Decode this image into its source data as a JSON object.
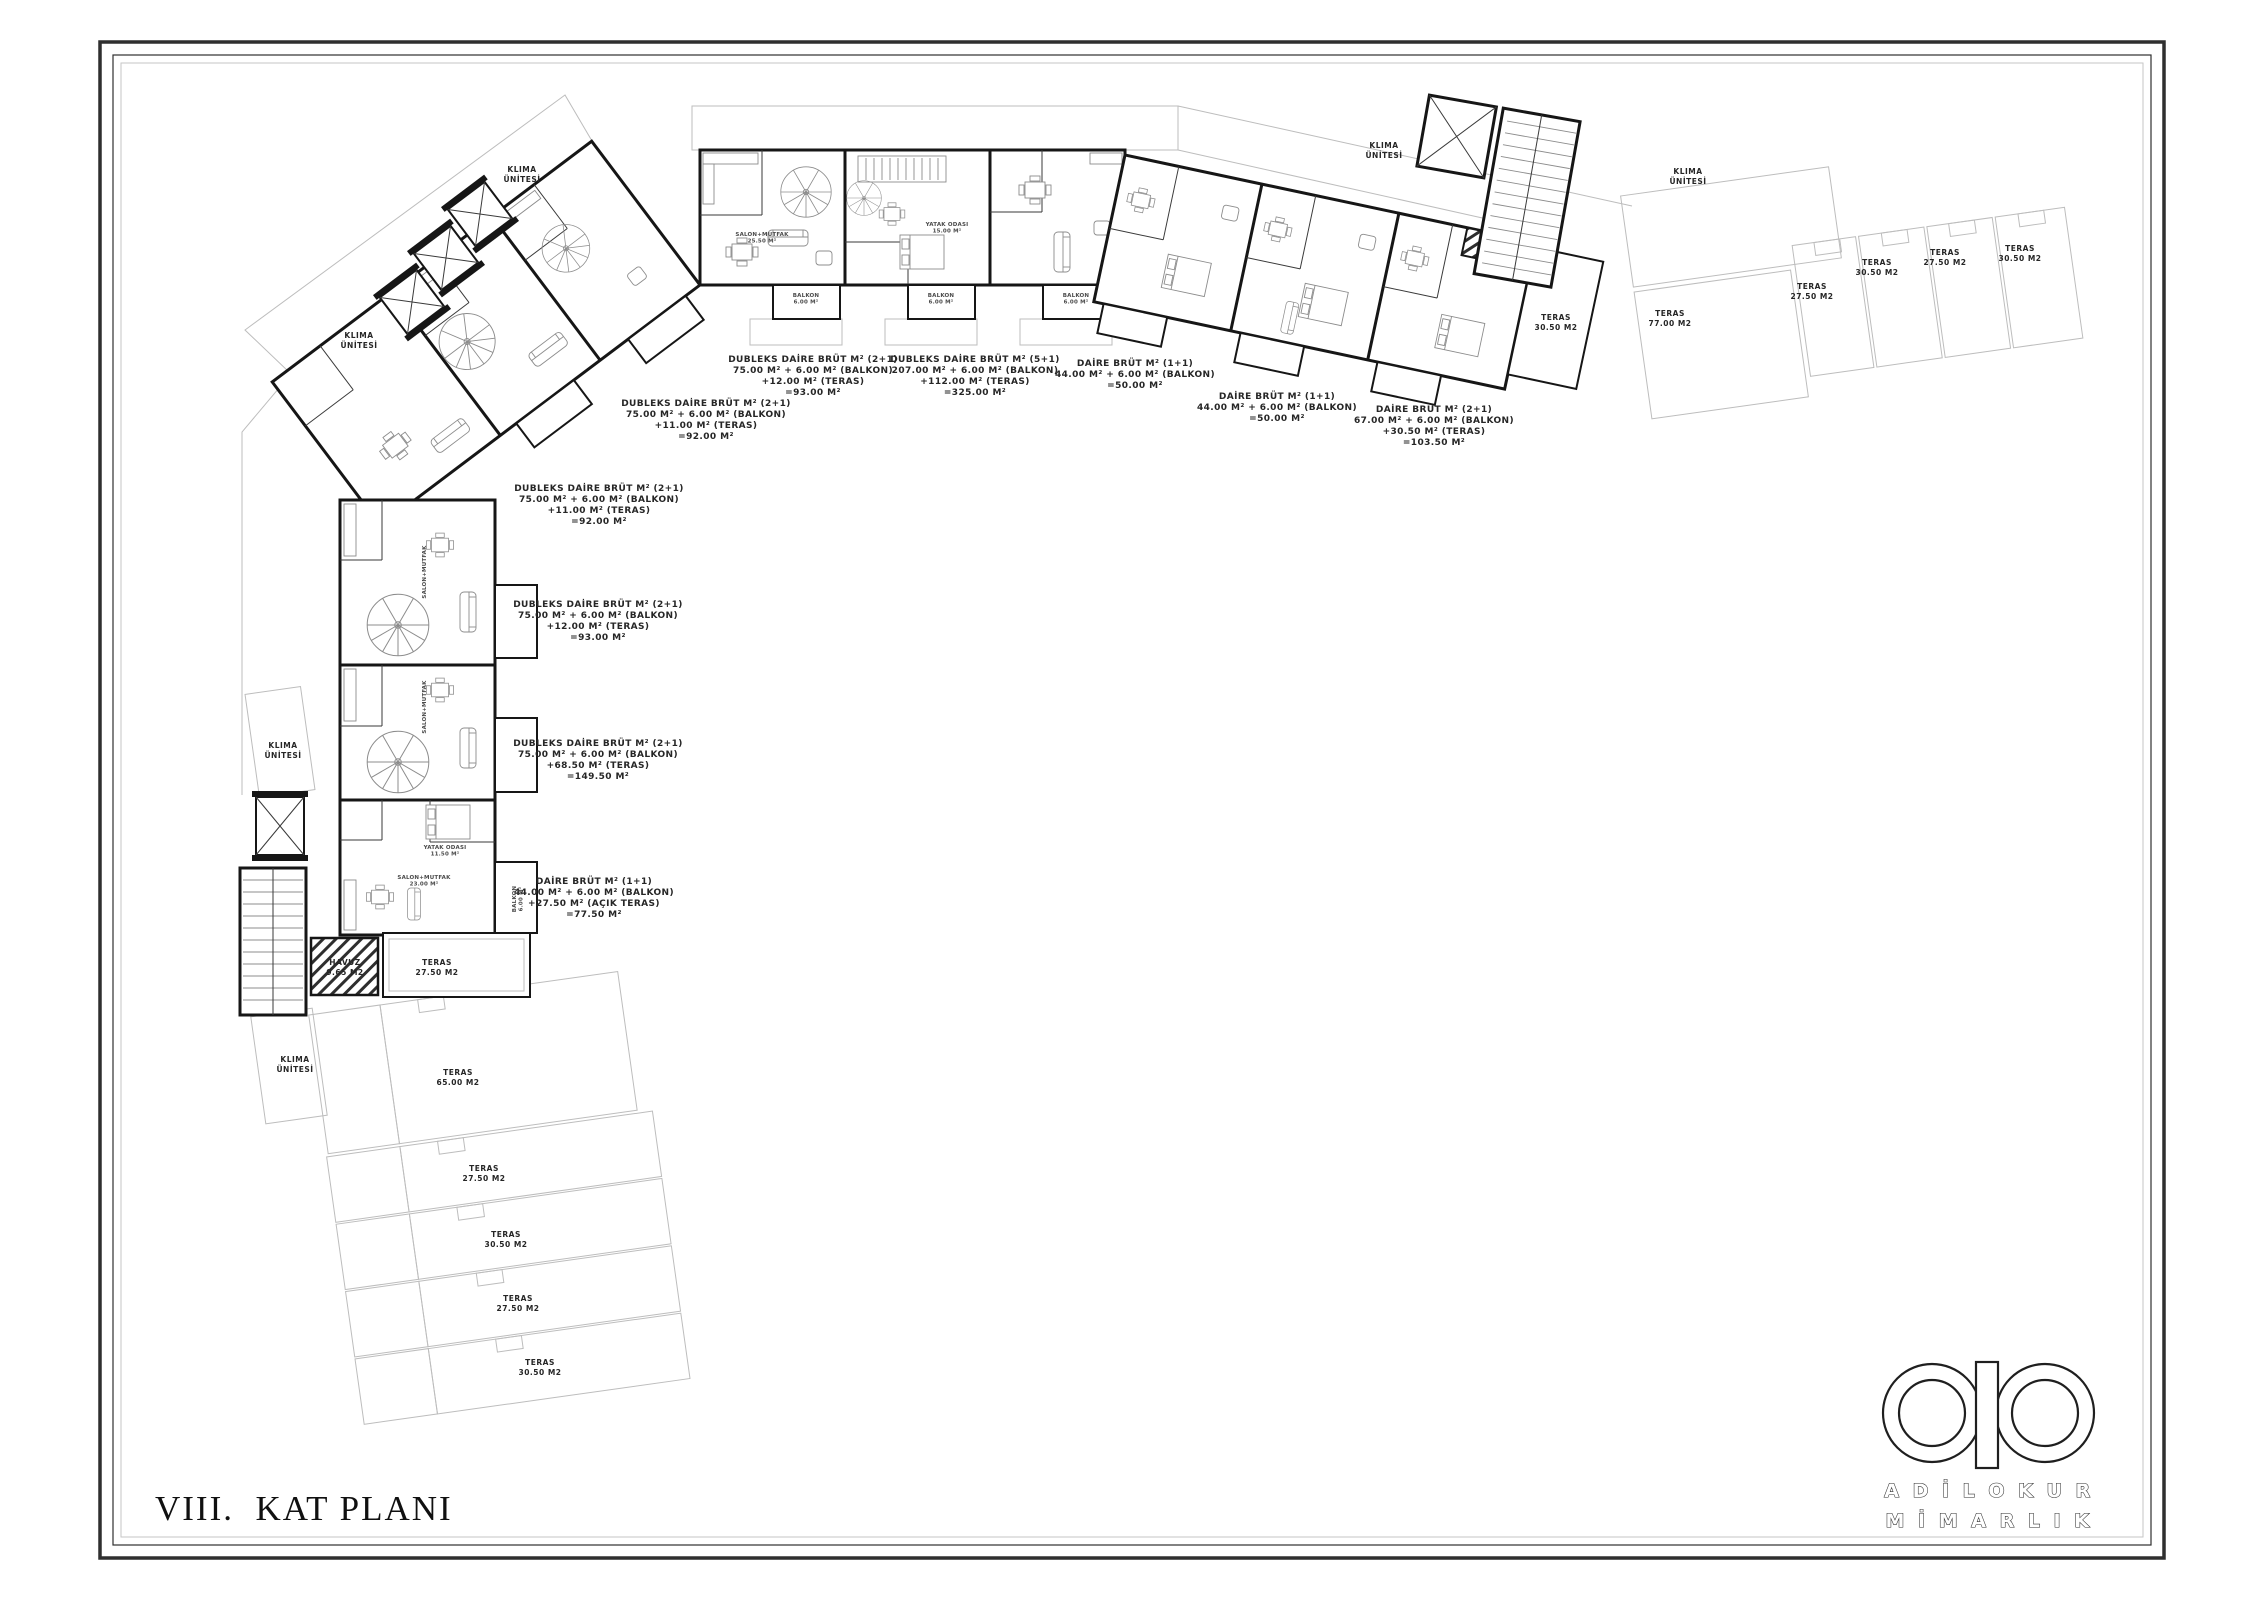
{
  "sheet": {
    "title": "VIII.  KAT PLANI"
  },
  "logo": {
    "line1": "A D İ L O K U R",
    "line2": "M İ M A R L I K"
  },
  "colors": {
    "wall": "#161616",
    "faint": "#bdbdbd",
    "furniture": "#8c8c8c",
    "text": "#262626"
  },
  "area_labels": [
    {
      "x": 813,
      "y": 362,
      "lines": [
        "DUBLEKS DAİRE BRÜT M² (2+1)",
        "75.00 M² + 6.00 M² (BALKON)",
        "+12.00 M² (TERAS)",
        "=93.00 M²"
      ]
    },
    {
      "x": 975,
      "y": 362,
      "lines": [
        "DUBLEKS DAİRE BRÜT M² (5+1)",
        "207.00 M² + 6.00 M² (BALKON)",
        "+112.00 M² (TERAS)",
        "=325.00 M²"
      ]
    },
    {
      "x": 1135,
      "y": 366,
      "lines": [
        "DAİRE BRÜT M² (1+1)",
        "44.00 M² + 6.00 M² (BALKON)",
        "=50.00 M²"
      ]
    },
    {
      "x": 706,
      "y": 406,
      "lines": [
        "DUBLEKS DAİRE BRÜT M² (2+1)",
        "75.00 M² + 6.00 M² (BALKON)",
        "+11.00 M² (TERAS)",
        "=92.00 M²"
      ]
    },
    {
      "x": 1277,
      "y": 399,
      "lines": [
        "DAİRE BRÜT M² (1+1)",
        "44.00 M² + 6.00 M² (BALKON)",
        "=50.00 M²"
      ]
    },
    {
      "x": 1434,
      "y": 412,
      "lines": [
        "DAİRE BRÜT M² (2+1)",
        "67.00 M² + 6.00 M² (BALKON)",
        "+30.50 M² (TERAS)",
        "=103.50 M²"
      ]
    },
    {
      "x": 599,
      "y": 491,
      "lines": [
        "DUBLEKS DAİRE BRÜT M² (2+1)",
        "75.00 M² + 6.00 M² (BALKON)",
        "+11.00 M² (TERAS)",
        "=92.00 M²"
      ]
    },
    {
      "x": 598,
      "y": 607,
      "lines": [
        "DUBLEKS DAİRE BRÜT M² (2+1)",
        "75.00 M² + 6.00 M² (BALKON)",
        "+12.00 M² (TERAS)",
        "=93.00 M²"
      ]
    },
    {
      "x": 598,
      "y": 746,
      "lines": [
        "DUBLEKS DAİRE BRÜT M² (2+1)",
        "75.00 M² + 6.00 M² (BALKON)",
        "+68.50 M² (TERAS)",
        "=149.50 M²"
      ]
    },
    {
      "x": 594,
      "y": 884,
      "lines": [
        "DAİRE BRÜT M² (1+1)",
        "44.00 M² + 6.00 M² (BALKON)",
        "+27.50 M² (AÇIK TERAS)",
        "=77.50 M²"
      ]
    }
  ],
  "klima_labels": [
    {
      "x": 522,
      "y": 172,
      "lines": [
        "KLIMA",
        "ÜNİTESİ"
      ]
    },
    {
      "x": 359,
      "y": 338,
      "lines": [
        "KLIMA",
        "ÜNİTESİ"
      ]
    },
    {
      "x": 283,
      "y": 748,
      "lines": [
        "KLIMA",
        "ÜNİTESİ"
      ]
    },
    {
      "x": 295,
      "y": 1062,
      "lines": [
        "KLIMA",
        "ÜNİTESİ"
      ]
    },
    {
      "x": 1384,
      "y": 148,
      "lines": [
        "KLIMA",
        "ÜNİTESİ"
      ]
    },
    {
      "x": 1688,
      "y": 174,
      "lines": [
        "KLIMA",
        "ÜNİTESİ"
      ]
    }
  ],
  "teras_labels": [
    {
      "x": 1670,
      "y": 316,
      "lines": [
        "TERAS",
        "77.00 M2"
      ]
    },
    {
      "x": 1812,
      "y": 289,
      "lines": [
        "TERAS",
        "27.50 M2"
      ]
    },
    {
      "x": 1877,
      "y": 265,
      "lines": [
        "TERAS",
        "30.50 M2"
      ]
    },
    {
      "x": 1945,
      "y": 255,
      "lines": [
        "TERAS",
        "27.50 M2"
      ]
    },
    {
      "x": 2020,
      "y": 251,
      "lines": [
        "TERAS",
        "30.50 M2"
      ]
    },
    {
      "x": 1556,
      "y": 320,
      "lines": [
        "TERAS",
        "30.50 M2"
      ]
    },
    {
      "x": 437,
      "y": 965,
      "lines": [
        "TERAS",
        "27.50 M2"
      ]
    },
    {
      "x": 345,
      "y": 965,
      "lines": [
        "HAVUZ",
        "9.65 M2"
      ]
    },
    {
      "x": 458,
      "y": 1075,
      "lines": [
        "TERAS",
        "65.00 M2"
      ]
    },
    {
      "x": 484,
      "y": 1171,
      "lines": [
        "TERAS",
        "27.50 M2"
      ]
    },
    {
      "x": 506,
      "y": 1237,
      "lines": [
        "TERAS",
        "30.50 M2"
      ]
    },
    {
      "x": 518,
      "y": 1301,
      "lines": [
        "TERAS",
        "27.50 M2"
      ]
    },
    {
      "x": 540,
      "y": 1365,
      "lines": [
        "TERAS",
        "30.50 M2"
      ]
    }
  ],
  "micro_labels": [
    {
      "x": 806,
      "y": 297,
      "lines": [
        "BALKON",
        "6.00 M²"
      ]
    },
    {
      "x": 941,
      "y": 297,
      "lines": [
        "BALKON",
        "6.00 M²"
      ]
    },
    {
      "x": 1076,
      "y": 297,
      "lines": [
        "BALKON",
        "6.00 M²"
      ]
    },
    {
      "x": 762,
      "y": 236,
      "lines": [
        "SALON+MUTFAK",
        "25.50 M²"
      ]
    },
    {
      "x": 947,
      "y": 226,
      "lines": [
        "YATAK ODASI",
        "15.00 M²"
      ]
    },
    {
      "x": 426,
      "y": 572,
      "lines": [
        "SALON+MUTFAK"
      ]
    },
    {
      "x": 426,
      "y": 707,
      "lines": [
        "SALON+MUTFAK"
      ]
    },
    {
      "x": 445,
      "y": 849,
      "lines": [
        "YATAK ODASI",
        "11.50 M²"
      ]
    },
    {
      "x": 424,
      "y": 879,
      "lines": [
        "SALON+MUTFAK",
        "23.00 M²"
      ]
    },
    {
      "x": 516,
      "y": 899,
      "lines": [
        "BALKON",
        "6.00 M²"
      ]
    }
  ]
}
